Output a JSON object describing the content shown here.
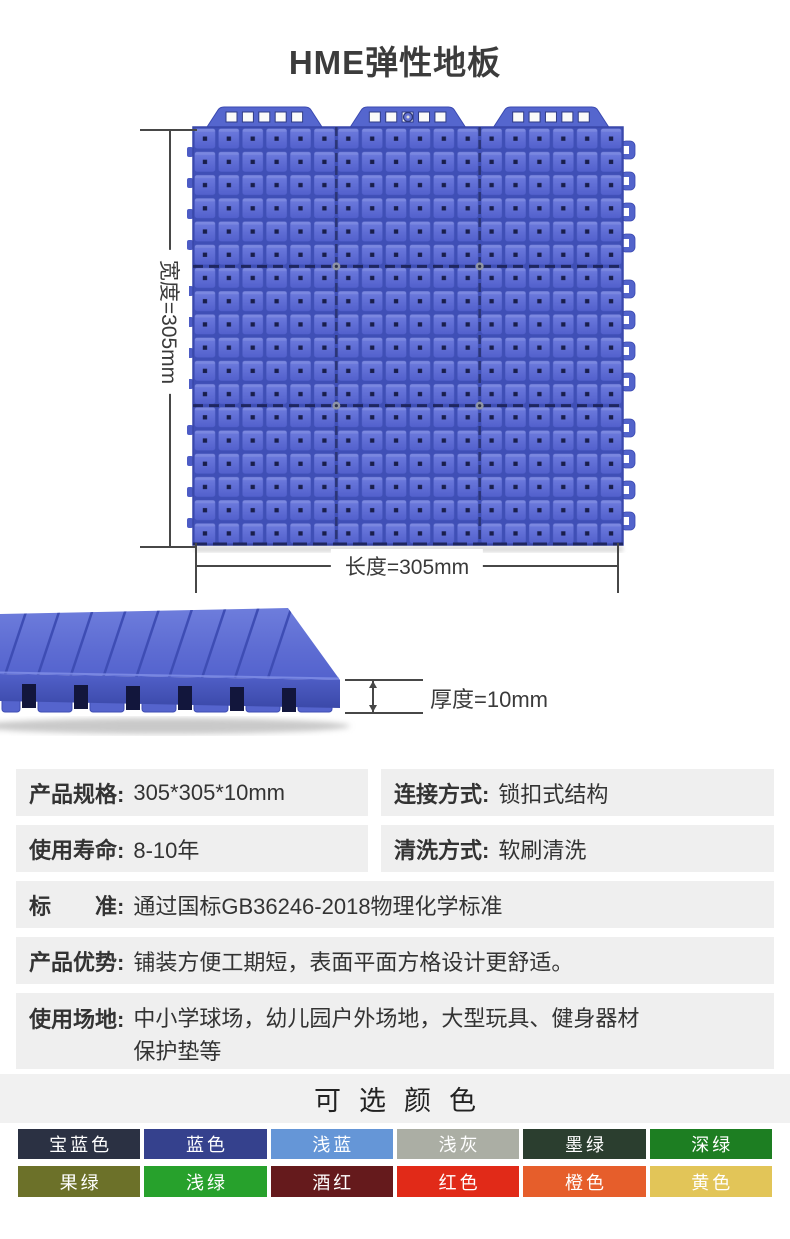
{
  "page": {
    "title": "HME弹性地板",
    "background": "#ffffff"
  },
  "product_image": {
    "description_name": "blue-interlock-floor-tiles-3x3",
    "tile_color": "#5a68ce",
    "tile_groove_color": "#3f4fb6",
    "width_label": "宽度=305mm",
    "length_label": "长度=305mm",
    "thickness_label": "厚度=10mm"
  },
  "specs": {
    "rows": [
      {
        "label": "产品规格:",
        "value": "305*305*10mm"
      },
      {
        "label": "连接方式:",
        "value": "锁扣式结构"
      },
      {
        "label": "使用寿命:",
        "value": "8-10年"
      },
      {
        "label": "清洗方式:",
        "value": "软刷清洗"
      },
      {
        "label": "标　　准:",
        "value": "通过国标GB36246-2018物理化学标准"
      },
      {
        "label": "产品优势:",
        "value": "铺装方便工期短，表面平面方格设计更舒适。"
      },
      {
        "label": "使用场地:",
        "value": "中小学球场，幼儿园户外场地，大型玩具、健身器材保护垫等"
      }
    ],
    "row_background": "#efefef"
  },
  "colors_section": {
    "title": "可选颜色",
    "swatches": [
      {
        "name": "宝蓝色",
        "hex": "#2b3143"
      },
      {
        "name": "蓝色",
        "hex": "#35418d"
      },
      {
        "name": "浅蓝",
        "hex": "#6596d7"
      },
      {
        "name": "浅灰",
        "hex": "#abaea4"
      },
      {
        "name": "墨绿",
        "hex": "#2b3e2f"
      },
      {
        "name": "深绿",
        "hex": "#1d7e22"
      },
      {
        "name": "果绿",
        "hex": "#6c7129"
      },
      {
        "name": "浅绿",
        "hex": "#27a12c"
      },
      {
        "name": "酒红",
        "hex": "#651a1c"
      },
      {
        "name": "红色",
        "hex": "#e12a18"
      },
      {
        "name": "橙色",
        "hex": "#e65e2b"
      },
      {
        "name": "黄色",
        "hex": "#e2c558"
      }
    ]
  }
}
